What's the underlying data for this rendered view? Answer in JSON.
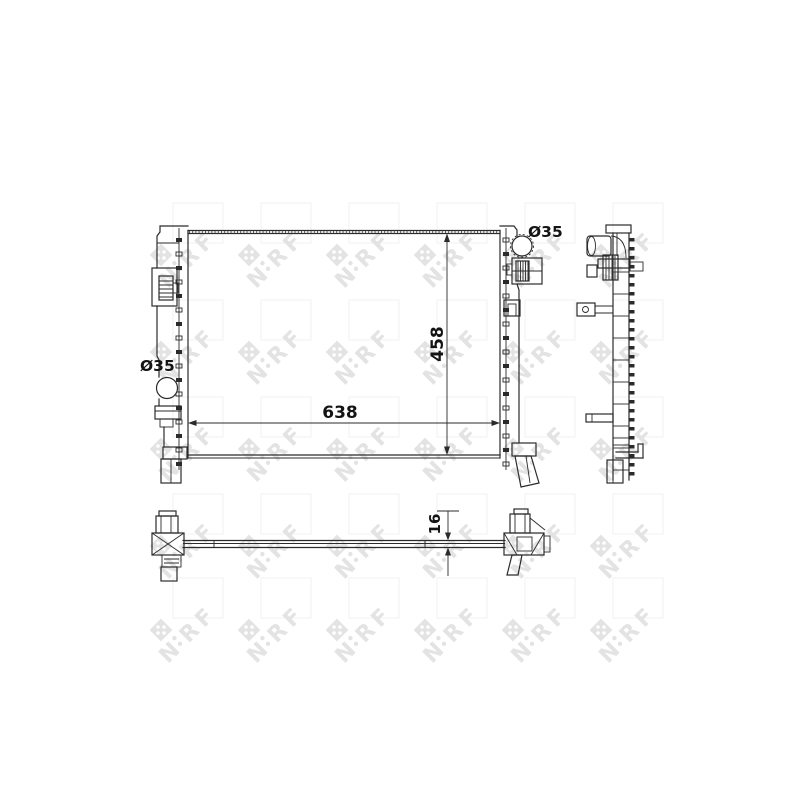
{
  "image": {
    "type": "technical-line-drawing",
    "subject": "radiator with three orthographic views"
  },
  "watermark": {
    "letters": [
      "N",
      "R",
      "F"
    ],
    "color": "#e3e3e3"
  },
  "dimensions": {
    "core_width_mm": "638",
    "core_height_mm": "458",
    "core_thickness_mm": "16",
    "top_pipe_diameter": "Ø35",
    "side_pipe_diameter": "Ø35"
  },
  "colors": {
    "line": "#2b2b2b",
    "text": "#141414",
    "background": "#ffffff"
  }
}
